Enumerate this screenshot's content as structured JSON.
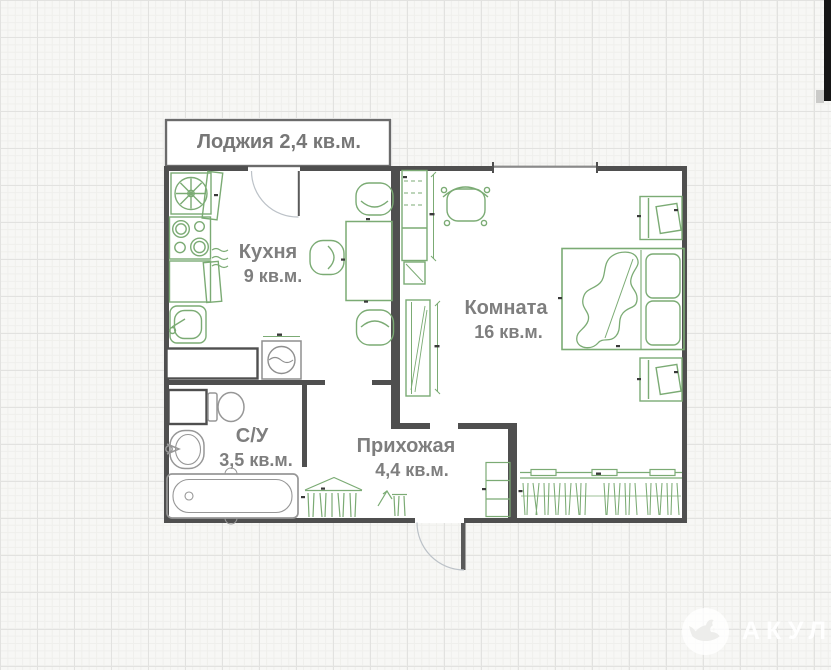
{
  "plan": {
    "title": "apartment-floor-plan",
    "rooms": [
      {
        "id": "loggia",
        "label": "Лоджия 2,4 кв.м.",
        "name": "Лоджия",
        "area": "2,4 кв.м."
      },
      {
        "id": "kitchen",
        "name": "Кухня",
        "area": "9 кв.м."
      },
      {
        "id": "room",
        "name": "Комната",
        "area": "16 кв.м."
      },
      {
        "id": "bathroom",
        "name": "С/У",
        "area": "3,5 кв.м."
      },
      {
        "id": "hallway",
        "name": "Прихожая",
        "area": "4,4 кв.м."
      }
    ],
    "furniture": [
      "extractor-fan",
      "kitchen-cabinet",
      "stove",
      "kitchen-sink",
      "washing-machine",
      "dining-table",
      "chair",
      "shelving",
      "desk-chair",
      "tv-panel",
      "bed",
      "person-figure",
      "nightstand",
      "closet-rail",
      "hanging-clothes",
      "coat-rack",
      "wall-hook",
      "shoe-cabinet",
      "toilet",
      "washbasin",
      "bathtub"
    ]
  },
  "watermark": {
    "text": "АКУЛА",
    "logo": "shark-logo"
  },
  "colors": {
    "wall": "#4f4f4f",
    "furniture_green": "#7bab74",
    "fixture_gray": "#979797",
    "label_gray": "#7e7e7e",
    "door_arc": "#b9bdc4",
    "grid_background": "#f7f7f5",
    "floor_white": "#ffffff"
  }
}
